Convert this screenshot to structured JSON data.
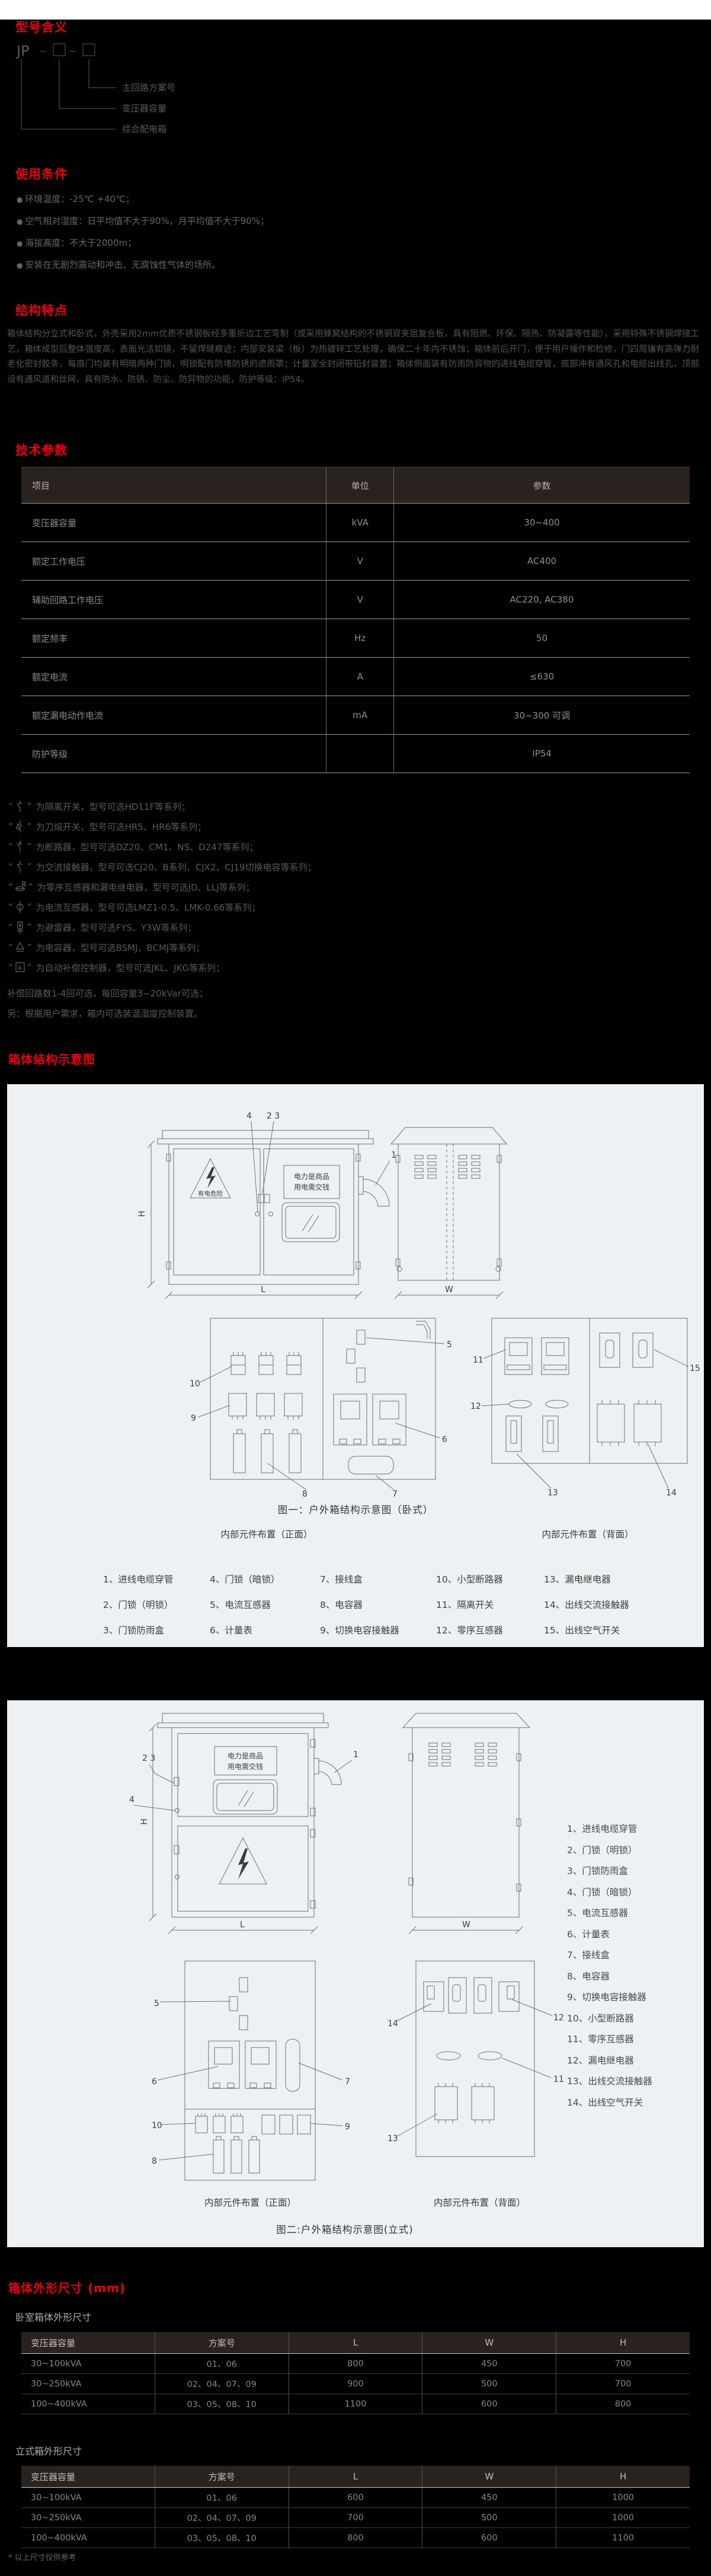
{
  "labels": {
    "H": "H",
    "L": "L",
    "W": "W",
    "jp": "JP",
    "dash": "－",
    "n1": "1",
    "n23": "2 3",
    "n4": "4",
    "n5": "5",
    "n6": "6",
    "n7": "7",
    "n8": "8",
    "n9": "9",
    "n10": "10",
    "n11": "11",
    "n12": "12",
    "n13": "13",
    "n14": "14",
    "n15": "15"
  },
  "model": {
    "title": "型号含义",
    "labels": [
      "主回路方案号",
      "变压器容量",
      "综合配电箱"
    ]
  },
  "usage": {
    "title": "使用条件",
    "bullets": [
      "环境温度：-25℃ +40℃；",
      "空气相对湿度：日平均值不大于90%，月平均值不大于90%；",
      "海拔高度：不大于2000m；",
      "安装在无剧烈震动和冲击、无腐蚀性气体的场所。"
    ]
  },
  "structure": {
    "title": "结构特点",
    "paragraph": "箱体结构分立式和卧式，外壳采用2mm优质不锈钢板经多重折边工艺弯制（或采用蜂窝结构的不锈钢双夹层复合板，具有阻燃、环保、隔热、防凝露等性能），采用特殊不锈钢焊接工艺，箱体成型后整体强度高，表面光洁如镜，不留焊缝痕迹；内部安装梁（板）为热镀锌工艺处理，确保二十年内不锈蚀；箱体前后开门，便于用户操作和检修，门四周镶有高弹力耐老化密封胶条，每扇门均装有明暗两种门锁，明锁配有防堵防锈的遮雨罩；计量室全封闭带铅封装置；箱体侧面装有防雨防异物的进线电缆穿管，底部冲有通风孔和电缆出线孔，顶部设有通风道和丝网，具有防水、防锈、防尘、防异物的功能，防护等级：IP54。"
  },
  "tech": {
    "title": "技术参数",
    "headers": [
      "项目",
      "单位",
      "参数"
    ],
    "rows": [
      [
        "变压器容量",
        "kVA",
        "30~400"
      ],
      [
        "额定工作电压",
        "V",
        "AC400"
      ],
      [
        "辅助回路工作电压",
        "V",
        "AC220, AC380"
      ],
      [
        "额定频率",
        "Hz",
        "50"
      ],
      [
        "额定电流",
        "A",
        "≤630"
      ],
      [
        "额定漏电动作电流",
        "mA",
        "30~300 可调"
      ],
      [
        "防护等级",
        "",
        "IP54"
      ]
    ]
  },
  "notes": {
    "controller_letter": "k",
    "items": [
      "为隔离开关，型号可选HD11F等系列；",
      "为刀熔开关，型号可选HR5、HR6等系列；",
      "为断路器，型号可选DZ20、CM1、NS、D247等系列；",
      "为交流接触器，型号可选CJ20、B系列，CJX2、CJ19切换电容等系列；",
      "为零序互感器和漏电继电器，型号可选JD、LLJ等系列；",
      "为电流互感器，型号可选LMZ1-0.5、LMK-0.66等系列；",
      "为避雷器，型号可选FYS、Y3W等系列；",
      "为电容器，型号可选BSMJ、BCMJ等系列；",
      "为自动补偿控制器，型号可选JKL、JKG等系列；"
    ],
    "extra1": "补偿回路数1-4回可选，每回容量3~20kVar可选；",
    "extra2": "另：根据用户需求，箱内可选装温湿度控制装置。"
  },
  "figures": {
    "section_title": "箱体结构示意图",
    "danger": "有电危险",
    "sign1": "电力是商品",
    "sign2": "用电需交钱",
    "front_caption": "内部元件布置（正面）",
    "back_caption": "内部元件布置（背面）"
  },
  "figure1": {
    "caption": "图一：户外箱结构示意图（卧式）",
    "legend_rows": [
      [
        "1、进线电缆穿管",
        "4、门锁（暗锁）",
        "7、接线盒",
        "10、小型断路器",
        "13、漏电继电器"
      ],
      [
        "2、门锁（明锁）",
        "5、电流互感器",
        "8、电容器",
        "11、隔离开关",
        "14、出线交流接触器"
      ],
      [
        "3、门锁防雨盒",
        "6、计量表",
        "9、切换电容接触器",
        "12、零序互感器",
        "15、出线空气开关"
      ]
    ]
  },
  "figure2": {
    "caption": "图二:户外箱结构示意图(立式)",
    "legend": [
      "1、进线电缆穿管",
      "2、门锁（明锁）",
      "3、门锁防雨盒",
      "4、门锁（暗锁）",
      "5、电流互感器",
      "6、计量表",
      "7、接线盒",
      "8、电容器",
      "9、切换电容接触器",
      "10、小型断路器",
      "11、零序互感器",
      "12、漏电继电器",
      "13、出线交流接触器",
      "14、出线空气开关"
    ]
  },
  "dims": {
    "title": "箱体外形尺寸 (mm)",
    "sub1": "卧室箱体外形尺寸",
    "sub2": "立式箱外形尺寸",
    "headers": [
      "变压器容量",
      "方案号",
      "L",
      "W",
      "H"
    ],
    "table1": [
      [
        "30~100kVA",
        "01、06",
        "800",
        "450",
        "700"
      ],
      [
        "30~250kVA",
        "02、04、07、09",
        "900",
        "500",
        "700"
      ],
      [
        "100~400kVA",
        "03、05、08、10",
        "1100",
        "600",
        "800"
      ]
    ],
    "table2": [
      [
        "30~100kVA",
        "01、06",
        "600",
        "450",
        "1000"
      ],
      [
        "30~250kVA",
        "02、04、07、09",
        "700",
        "500",
        "1000"
      ],
      [
        "100~400kVA",
        "03、05、08、10",
        "800",
        "600",
        "1100"
      ]
    ],
    "footnote": "* 以上尺寸仅供参考"
  }
}
